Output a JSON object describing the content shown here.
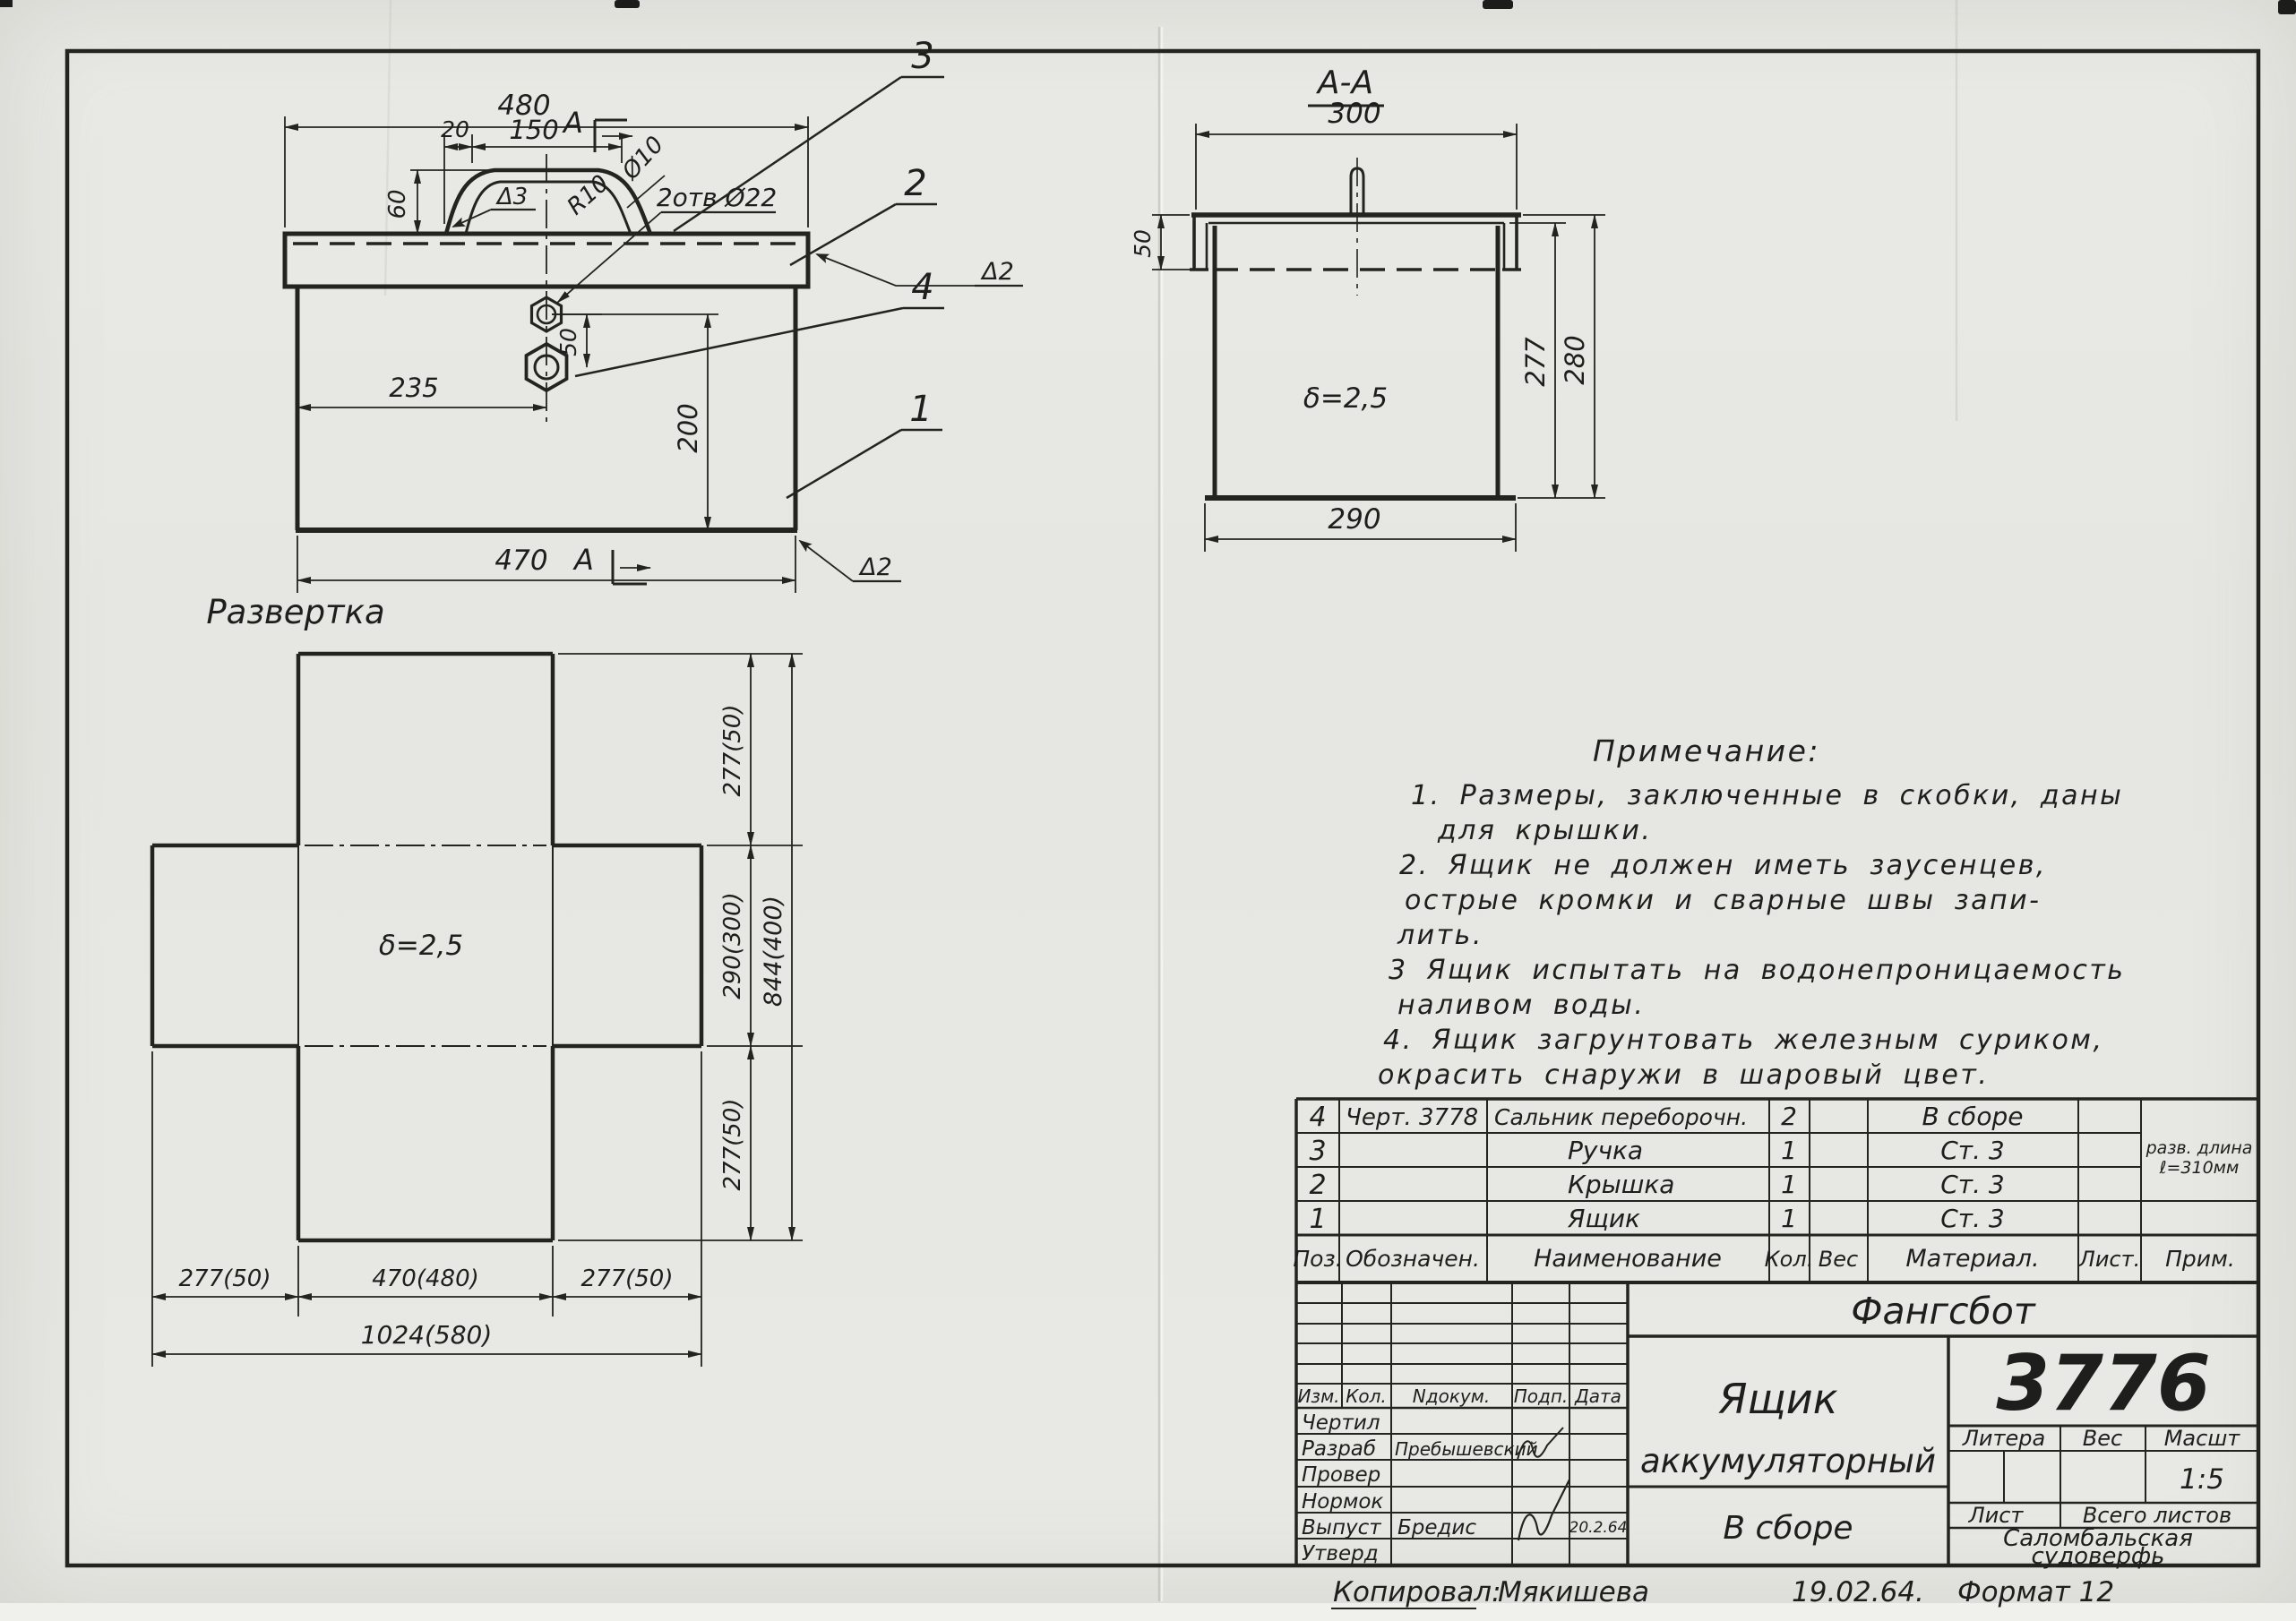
{
  "style": {
    "ink": "#23231f",
    "paper": "#e7e7e3"
  },
  "views": {
    "front": {
      "dim_480": "480",
      "dim_20": "20",
      "dim_150": "150",
      "section_letter_top": "А",
      "dim_60": "60",
      "weld_handle": "Δ3",
      "radius_label": "R10",
      "dia_label": "Ø10",
      "holes_label": "2отв Ø22",
      "dim_50": "50",
      "dim_235": "235",
      "dim_200": "200",
      "dim_470": "470",
      "section_letter_bottom": "А",
      "weld_lid": "Δ2",
      "weld_body": "Δ2",
      "callout_handle": "3",
      "callout_lid": "2",
      "callout_gland": "4",
      "callout_box": "1"
    },
    "section": {
      "title": "А-А",
      "dim_300": "300",
      "dim_50": "50",
      "dim_277": "277",
      "dim_280": "280",
      "thickness": "δ=2,5",
      "dim_290": "290"
    },
    "development": {
      "title": "Развертка",
      "thickness": "δ=2,5",
      "dim_top": "277(50)",
      "dim_mid": "290(300)",
      "dim_bot": "277(50)",
      "dim_total_v": "844(400)",
      "dim_left": "277(50)",
      "dim_center": "470(480)",
      "dim_right": "277(50)",
      "dim_total_h": "1024(580)"
    }
  },
  "notes": {
    "title": "Примечание:",
    "lines": [
      "1. Размеры, заключенные в скобки, даны",
      "для  крышки.",
      "2. Ящик  не должен  иметь  заусенцев,",
      "острые  кромки  и сварные  швы запи-",
      "лить.",
      "3 Ящик  испытать  на водонепроницаемость",
      "наливом  воды.",
      "4. Ящик  загрунтовать  железным  суриком,",
      "окрасить  снаружи  в  шаровый  цвет."
    ]
  },
  "parts_table": {
    "headers": [
      "Поз.",
      "Обозначен.",
      "Наименование",
      "Кол.",
      "Вес",
      "Материал.",
      "Лист.",
      "Прим."
    ],
    "rows": [
      {
        "pos": "4",
        "designation": "Черт. 3778",
        "name": "Сальник переборочн.",
        "qty": "2",
        "weight": "",
        "material": "В сборе",
        "sheet": "",
        "note1": "",
        "note2": ""
      },
      {
        "pos": "3",
        "designation": "",
        "name": "Ручка",
        "qty": "1",
        "weight": "",
        "material": "Ст. 3",
        "sheet": "",
        "note1": "разв. длина",
        "note2": "ℓ=310мм"
      },
      {
        "pos": "2",
        "designation": "",
        "name": "Крышка",
        "qty": "1",
        "weight": "",
        "material": "Ст. 3",
        "sheet": "",
        "note1": "",
        "note2": ""
      },
      {
        "pos": "1",
        "designation": "",
        "name": "Ящик",
        "qty": "1",
        "weight": "",
        "material": "Ст. 3",
        "sheet": "",
        "note1": "",
        "note2": ""
      }
    ]
  },
  "title_block": {
    "project": "Фангсбот",
    "drawing_number": "3776",
    "title_line1": "Ящик",
    "title_line2": "аккумуляторный",
    "subtitle": "В сборе",
    "litera_label": "Литера",
    "weight_label": "Вес",
    "scale_label": "Масшт",
    "scale_value": "1:5",
    "sheet_label": "Лист",
    "total_sheets_label": "Всего листов",
    "shipyard_line1": "Саломбальская",
    "shipyard_line2": "судоверфь",
    "rev_headers": [
      "Изм.",
      "Кол.",
      "Nдокум.",
      "Подп.",
      "Дата"
    ],
    "sig_rows": [
      {
        "label": "Чертил",
        "name": "",
        "date": ""
      },
      {
        "label": "Разраб",
        "name": "Пребышевский",
        "date": ""
      },
      {
        "label": "Провер",
        "name": "",
        "date": ""
      },
      {
        "label": "Нормок",
        "name": "",
        "date": ""
      },
      {
        "label": "Выпуст",
        "name": "Бредис",
        "date": "20.2.64"
      },
      {
        "label": "Утверд",
        "name": "",
        "date": ""
      }
    ],
    "footer": {
      "label": "Копировал:",
      "name": "Мякишева",
      "date": "19.02.64.",
      "format": "Формат 12"
    }
  }
}
